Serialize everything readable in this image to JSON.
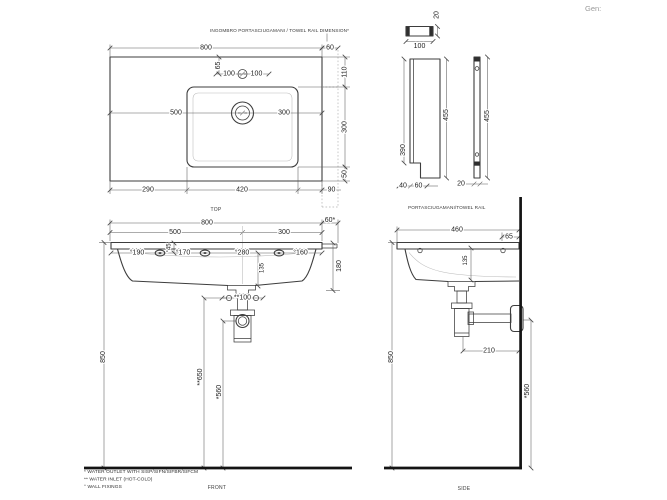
{
  "brand": "Gen:",
  "top_view": {
    "note": "INGOMBRO PORTASCIUGAMANI / TOWEL RAIL DIMENSION*",
    "label": "TOP",
    "width": "800",
    "rail_ext": "60",
    "rear_to_bowl": "110",
    "bowl_depth": "300",
    "bowl_front": "50",
    "tap_offset": "65",
    "tap_left": "100",
    "tap_right": "100",
    "drain_left": "500",
    "drain_right": "300",
    "left_margin": "290",
    "bowl_width": "420",
    "right_margin": "90"
  },
  "rail_views": {
    "label": "PORTASCIUGAMANI/TOWEL RAIL",
    "bar_thickness": "20",
    "bar_width": "100",
    "front_inner_height": "390",
    "front_total_height": "455",
    "foot_a": "40",
    "foot_b": "60",
    "side_total_height": "455",
    "side_thickness": "20"
  },
  "front_view": {
    "label": "FRONT",
    "width": "800",
    "rail_ext": "60*",
    "drain_left": "500",
    "drain_right": "300",
    "fix1": "°190",
    "fix_height": "°45",
    "fix2": "°170",
    "fix3": "°280",
    "basin_depth": "135",
    "fix4": "°160",
    "height_right": "180",
    "inlet_span": "**100",
    "total_height": "850",
    "inlet_height": "**650",
    "outlet_height": "*560"
  },
  "side_view": {
    "label": "SIDE",
    "depth": "460",
    "tap_from_wall": "65",
    "basin_depth": "135",
    "total_height": "850",
    "trap_to_wall": "210",
    "outlet_height": "*560"
  },
  "footnotes": [
    "* WATER OUTLET WITH SISP/SIFN/SIFBR/SIFCM",
    "** WATER INLET  (HOT-COLD)",
    "° WALL FIXINGS"
  ]
}
